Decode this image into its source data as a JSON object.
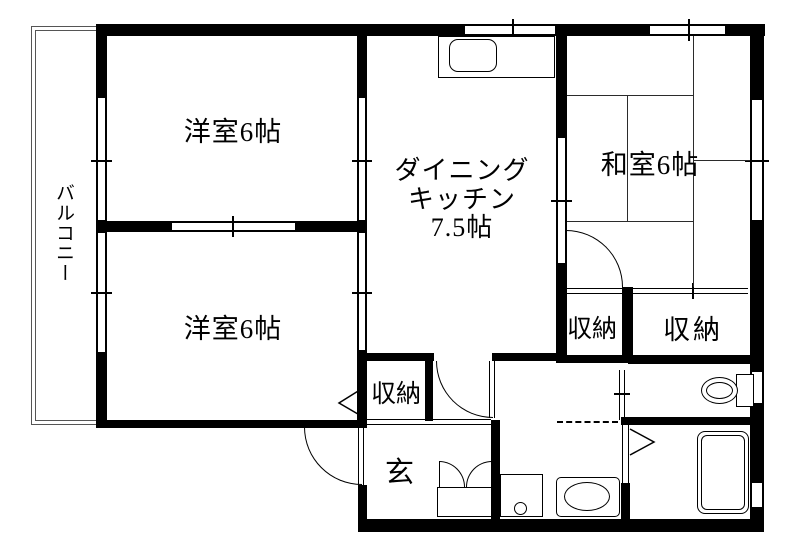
{
  "colors": {
    "wall": "#000000",
    "background": "#ffffff",
    "tatami_line": "#2b2b2b"
  },
  "rooms": {
    "balcony": {
      "label": "バルコニー"
    },
    "western_room_top": {
      "label": "洋室6帖"
    },
    "western_room_bottom": {
      "label": "洋室6帖"
    },
    "dining_kitchen": {
      "lines": [
        "ダイニング",
        "キッチン",
        "7.5帖"
      ]
    },
    "japanese_room": {
      "label": "和室6帖"
    },
    "closet_japanese_left": {
      "label": "収納"
    },
    "closet_japanese_right": {
      "label": "収納"
    },
    "closet_hall": {
      "label": "収納"
    },
    "entrance": {
      "label": "玄"
    }
  }
}
